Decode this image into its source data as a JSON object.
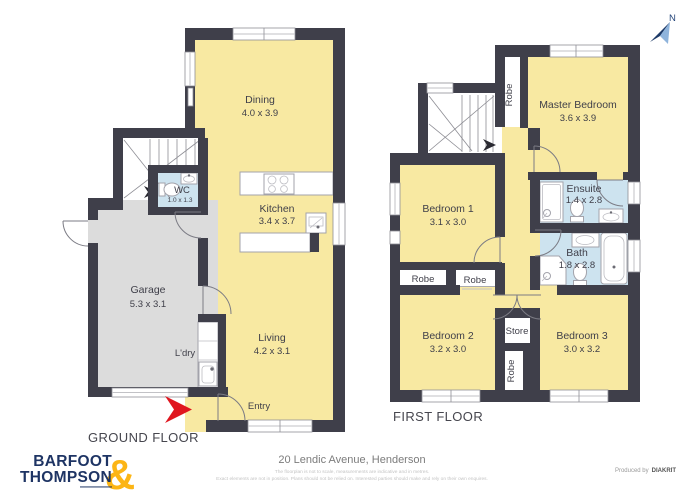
{
  "compass": {
    "label": "N"
  },
  "ground_floor": {
    "title": "GROUND FLOOR",
    "rooms": {
      "dining": {
        "name": "Dining",
        "dims": "4.0 x 3.9"
      },
      "kitchen": {
        "name": "Kitchen",
        "dims": "3.4 x 3.7"
      },
      "wc": {
        "name": "WC",
        "dims": "1.0 x 1.3"
      },
      "garage": {
        "name": "Garage",
        "dims": "5.3 x 3.1"
      },
      "laundry": {
        "name": "L'dry"
      },
      "living": {
        "name": "Living",
        "dims": "4.2 x 3.1"
      },
      "entry": {
        "name": "Entry"
      }
    }
  },
  "first_floor": {
    "title": "FIRST FLOOR",
    "rooms": {
      "master": {
        "name": "Master Bedroom",
        "dims": "3.6 x 3.9"
      },
      "robe_master": {
        "label": "Robe"
      },
      "bedroom1": {
        "name": "Bedroom 1",
        "dims": "3.1 x 3.0"
      },
      "ensuite": {
        "name": "Ensuite",
        "dims": "1.4 x 2.8"
      },
      "bath": {
        "name": "Bath",
        "dims": "1.8 x 2.8"
      },
      "robe1": {
        "label": "Robe"
      },
      "robe2": {
        "label": "Robe"
      },
      "bedroom2": {
        "name": "Bedroom 2",
        "dims": "3.2 x 3.0"
      },
      "store": {
        "label": "Store"
      },
      "robe3": {
        "label": "Robe"
      },
      "bedroom3": {
        "name": "Bedroom 3",
        "dims": "3.0 x 3.2"
      }
    }
  },
  "footer": {
    "address": "20 Lendic Avenue, Henderson",
    "disclaimer_line1": "The floorplan is not to scale, measurements are indicative and in metres.",
    "disclaimer_line2": "Exact elements are not in position. Plans should not be relied on. Interested parties should make and rely on their own enquires.",
    "credit_prefix": "Produced by",
    "credit_brand": "DIAKRIT"
  },
  "logo": {
    "line1": "BARFOOT",
    "line2": "THOMPSON",
    "ampersand": "&"
  },
  "colors": {
    "wall": "#3f3f4a",
    "room_yellow": "#f8e9a2",
    "wet_blue": "#cde3ef",
    "garage_gray": "#dcdcdc",
    "entry_arrow_red": "#e0161f",
    "logo_navy": "#1e3464",
    "logo_gold": "#fcb515",
    "compass_navy": "#1d3a68",
    "compass_light": "#8fb4dc"
  }
}
